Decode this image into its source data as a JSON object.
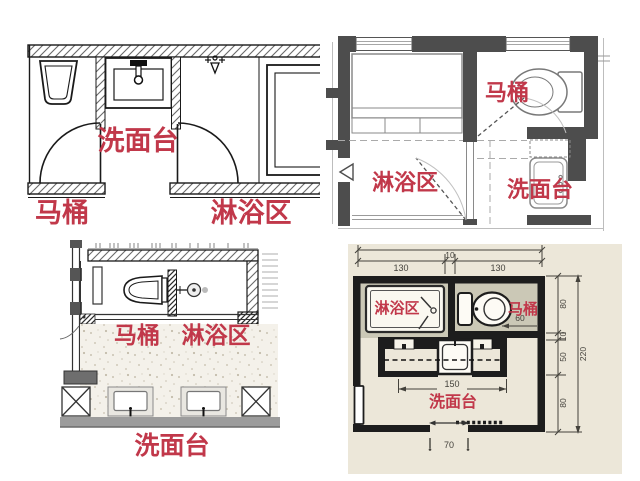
{
  "accent_color": "#c1384a",
  "panels": {
    "top_left": {
      "labels": {
        "sink": "洗面台",
        "toilet": "马桶",
        "shower": "淋浴区"
      }
    },
    "top_right": {
      "labels": {
        "toilet": "马桶",
        "shower": "淋浴区",
        "sink": "洗面台"
      }
    },
    "bottom_left": {
      "labels": {
        "toilet": "马桶",
        "shower": "淋浴区",
        "sink": "洗面台"
      }
    },
    "bottom_right": {
      "labels": {
        "shower": "淋浴区",
        "toilet": "马桶",
        "sink": "洗面台"
      },
      "dims": {
        "top_left": "130",
        "top_mid": "10",
        "top_right": "130",
        "right_1": "80",
        "right_2": "10",
        "right_3": "50",
        "right_4": "80",
        "right_total": "220",
        "toilet_clearance": "60",
        "vanity_width": "150",
        "door_width": "70"
      }
    }
  }
}
